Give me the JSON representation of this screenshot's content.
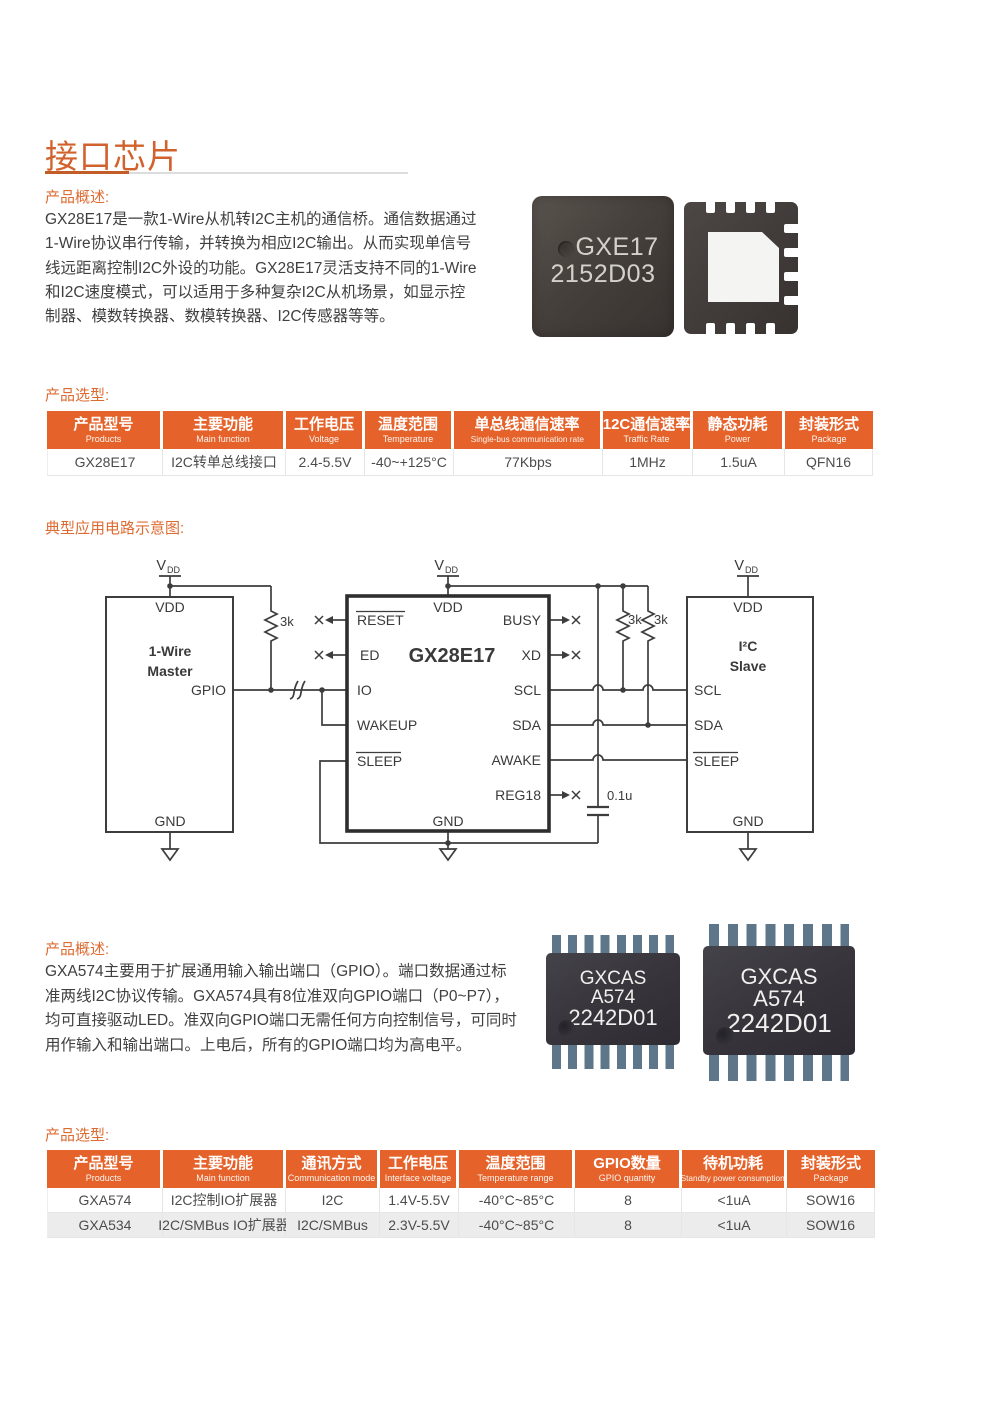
{
  "colors": {
    "accent_orange": "#e5632a",
    "title_orange": "#d2622d",
    "row_stripe": "#ececec"
  },
  "page": {
    "title": "接口芯片"
  },
  "section1": {
    "overview_label": "产品概述:",
    "overview_lines": [
      "GX28E17是一款1-Wire从机转I2C主机的通信桥。通信数据通过",
      "1-Wire协议串行传输，并转换为相应I2C输出。从而实现单信号",
      "线远距离控制I2C外设的功能。GX28E17灵活支持不同的1-Wire",
      "和I2C速度模式，可以适用于多种复杂I2C从机场景，如显示控",
      "制器、模数转换器、数模转换器、I2C传感器等等。"
    ],
    "chip_marking": {
      "line1": "GXE17",
      "line2": "2152D03"
    },
    "selection_label": "产品选型:",
    "table": {
      "headers": [
        {
          "zh": "产品型号",
          "en": "Products"
        },
        {
          "zh": "主要功能",
          "en": "Main function"
        },
        {
          "zh": "工作电压",
          "en": "Voltage"
        },
        {
          "zh": "温度范围",
          "en": "Temperature"
        },
        {
          "zh": "单总线通信速率",
          "en": "Single-bus communication rate"
        },
        {
          "zh": "12C通信速率",
          "en": "Traffic Rate"
        },
        {
          "zh": "静态功耗",
          "en": "Power"
        },
        {
          "zh": "封装形式",
          "en": "Package"
        }
      ],
      "row": [
        "GX28E17",
        "I2C转单总线接口",
        "2.4-5.5V",
        "-40~+125°C",
        "77Kbps",
        "1MHz",
        "1.5uA",
        "QFN16"
      ]
    }
  },
  "circuit": {
    "label": "典型应用电路示意图:",
    "supply": {
      "v": "V",
      "sub": "DD"
    },
    "master": {
      "vdd": "VDD",
      "name1": "1-Wire",
      "name2": "Master",
      "gpio": "GPIO",
      "gnd": "GND"
    },
    "chip": {
      "name": "GX28E17",
      "vdd": "VDD",
      "gnd": "GND",
      "reset": "RESET",
      "ed": "ED",
      "io": "IO",
      "wakeup": "WAKEUP",
      "sleep": "SLEEP",
      "busy": "BUSY",
      "xd": "XD",
      "scl": "SCL",
      "sda": "SDA",
      "awake": "AWAKE",
      "reg18": "REG18"
    },
    "slave": {
      "vdd": "VDD",
      "name1": "I²C",
      "name2": "Slave",
      "scl": "SCL",
      "sda": "SDA",
      "sleep": "SLEEP",
      "gnd": "GND"
    },
    "r_left": "3k",
    "r_scl": "3k",
    "r_sda": "3k",
    "cap": "0.1u"
  },
  "section2": {
    "overview_label": "产品概述:",
    "overview_lines": [
      "GXA574主要用于扩展通用输入输出端口（GPIO）。端口数据通过标",
      "准两线I2C协议传输。GXA574具有8位准双向GPIO端口（P0~P7），",
      "均可直接驱动LED。准双向GPIO端口无需任何方向控制信号，可同时",
      "用作输入和输出端口。上电后，所有的GPIO端口均为高电平。"
    ],
    "chip_marking": {
      "line1": "GXCAS",
      "line2": "A574",
      "line3": "2242D01"
    },
    "selection_label": "产品选型:",
    "table": {
      "headers": [
        {
          "zh": "产品型号",
          "en": "Products"
        },
        {
          "zh": "主要功能",
          "en": "Main function"
        },
        {
          "zh": "通讯方式",
          "en": "Communication mode"
        },
        {
          "zh": "工作电压",
          "en": "Interface voltage"
        },
        {
          "zh": "温度范围",
          "en": "Temperature range"
        },
        {
          "zh": "GPIO数量",
          "en": "GPIO quantity"
        },
        {
          "zh": "待机功耗",
          "en": "Standby power consumption"
        },
        {
          "zh": "封装形式",
          "en": "Package"
        }
      ],
      "rows": [
        [
          "GXA574",
          "I2C控制IO扩展器",
          "I2C",
          "1.4V-5.5V",
          "-40°C~85°C",
          "8",
          "<1uA",
          "SOW16"
        ],
        [
          "GXA534",
          "I2C/SMBus IO扩展器",
          "I2C/SMBus",
          "2.3V-5.5V",
          "-40°C~85°C",
          "8",
          "<1uA",
          "SOW16"
        ]
      ]
    }
  }
}
